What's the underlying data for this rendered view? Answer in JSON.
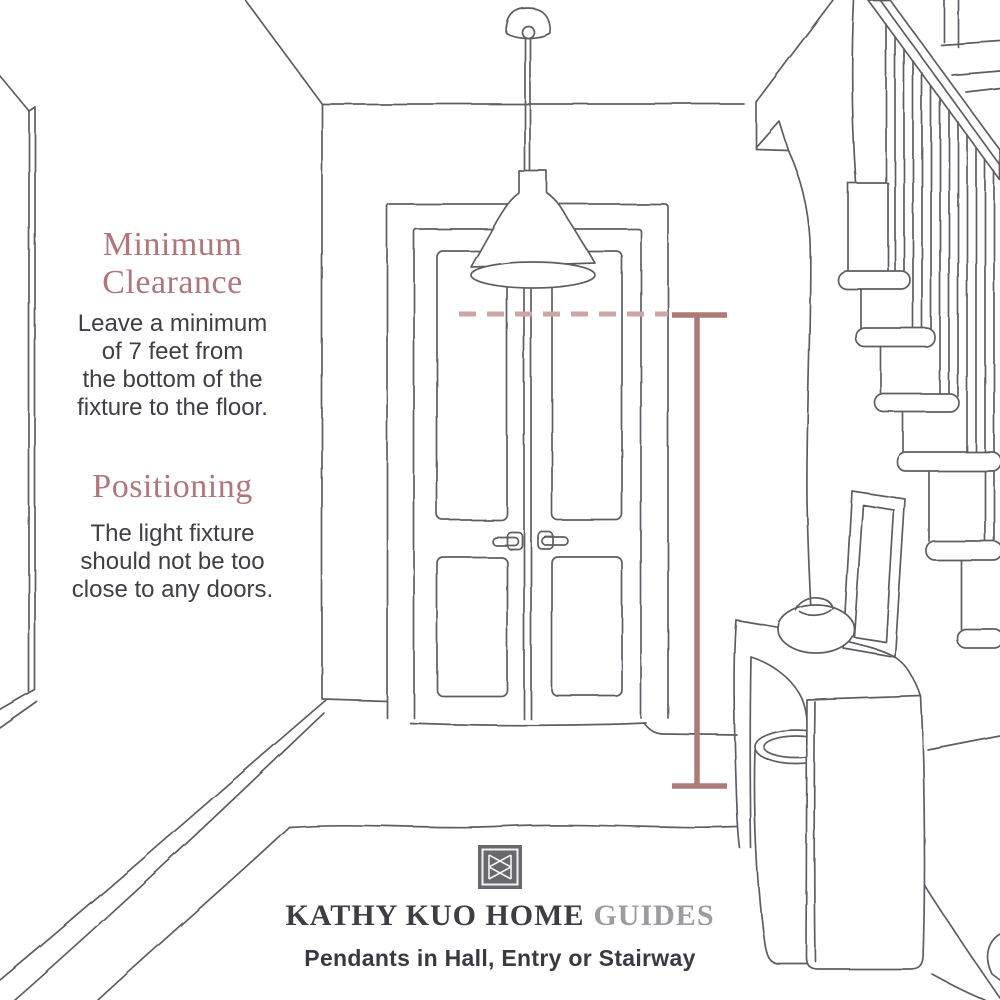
{
  "page": {
    "background": "#ffffff",
    "title": "Pendant light clearance guide illustration"
  },
  "sections": {
    "clearance": {
      "heading_lines": [
        "Minimum",
        "Clearance"
      ],
      "body_lines": [
        "Leave a minimum",
        "of 7 feet from",
        "the bottom of the",
        "fixture to the floor."
      ]
    },
    "positioning": {
      "heading_lines": [
        "Positioning"
      ],
      "body_lines": [
        "The light fixture",
        "should not be too",
        "close to any doors."
      ]
    }
  },
  "footer": {
    "brand": "KATHY KUO HOME",
    "series": "GUIDES",
    "caption": "Pendants in Hall, Entry or Stairway",
    "logo": "kathy-kuo-home-monogram"
  },
  "illustration": {
    "description": "Hand-drawn line sketch of an entry hallway: pendant cone light hanging over double doors, staircase with banister on the right, console table with bowl, leaning picture frame and basket, rug on floor",
    "elements": [
      "pendant-light",
      "double-door",
      "door-handles",
      "staircase",
      "handrail",
      "balusters",
      "stair-treads",
      "console-table",
      "decor-bowl",
      "picture-frame",
      "basket",
      "rug",
      "minimum-clearance-dashed-line",
      "seven-foot-measurement-line"
    ]
  },
  "colors": {
    "heading": "#b1767b",
    "body_text": "#3f3e45",
    "brand_text": "#3e3d44",
    "series_text": "#9c9ba3",
    "caption_text": "#3a3942",
    "line_art": "#5f5c64",
    "measurement_line": "#ac7a77",
    "dashed_clearance_line": "#cba6a3",
    "logo_background": "#68686c"
  }
}
